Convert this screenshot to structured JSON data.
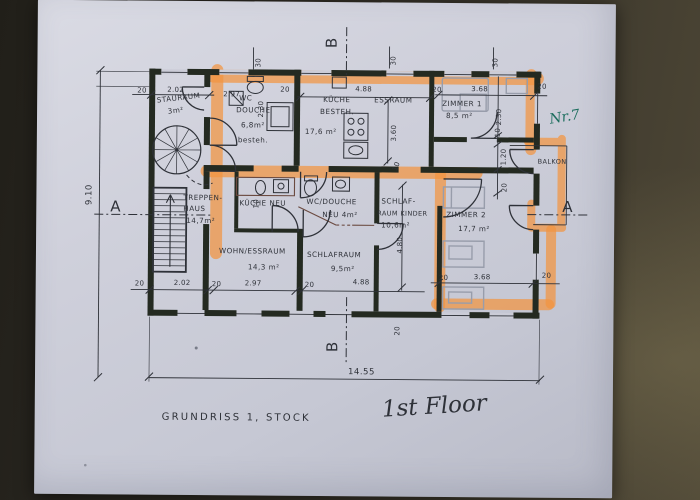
{
  "plan": {
    "title_de": "GRUNDRISS  1, STOCK",
    "title_en": "1st Floor",
    "note": "Nr.7",
    "sections": {
      "a": "A",
      "b": "B"
    },
    "rooms": {
      "staurraum": [
        "STAURAUM",
        "3m²"
      ],
      "wc_douche": [
        "WC",
        "DOUCHE",
        "6,8m²",
        "besteh."
      ],
      "kueche_besteh": [
        "KÜCHE",
        "BESTEH.",
        "17,6 m²"
      ],
      "essraum": [
        "ESSRAUM"
      ],
      "zimmer1": [
        "ZIMMER 1",
        "8,5 m²"
      ],
      "balkon": [
        "BALKON"
      ],
      "treppenhaus": [
        "TREPPEN-",
        "HAUS",
        "14,7m²"
      ],
      "kueche_neu": [
        "KÜCHE NEU"
      ],
      "wc_douche_neu": [
        "WC/DOUCHE",
        "NEU 4m²"
      ],
      "schlafraum_kinder": [
        "SCHLAF-",
        "RAUM KINDER",
        "10,6m²"
      ],
      "zimmer2": [
        "ZIMMER 2",
        "17,7 m²"
      ],
      "wohn_essraum": [
        "WOHN/ESSRAUM",
        "14,3 m²"
      ],
      "schlafraum": [
        "SCHLAFRAUM",
        "9,5m²"
      ]
    },
    "dims": {
      "top": [
        "20",
        "2.02",
        "2.97",
        "20",
        "4.88",
        "20",
        "3.68",
        "20"
      ],
      "bottom": [
        "20",
        "2.02",
        "20",
        "2.97",
        "20",
        "4.88",
        "20",
        "3.68",
        "20"
      ],
      "total_width": "14.55",
      "total_height": "9.10",
      "zimmer1_side": [
        "2.30",
        "10",
        "1.20",
        "20"
      ],
      "wc_side": [
        "2.30",
        "10"
      ],
      "essraum_height": "3.60",
      "kinder_height": "4.80",
      "wall_30s": [
        "30",
        "30",
        "30"
      ],
      "corridor_width": "10",
      "b_offset": "20"
    },
    "colors": {
      "highlighter": "#F29442",
      "green_note": "#1D6E5E"
    }
  }
}
